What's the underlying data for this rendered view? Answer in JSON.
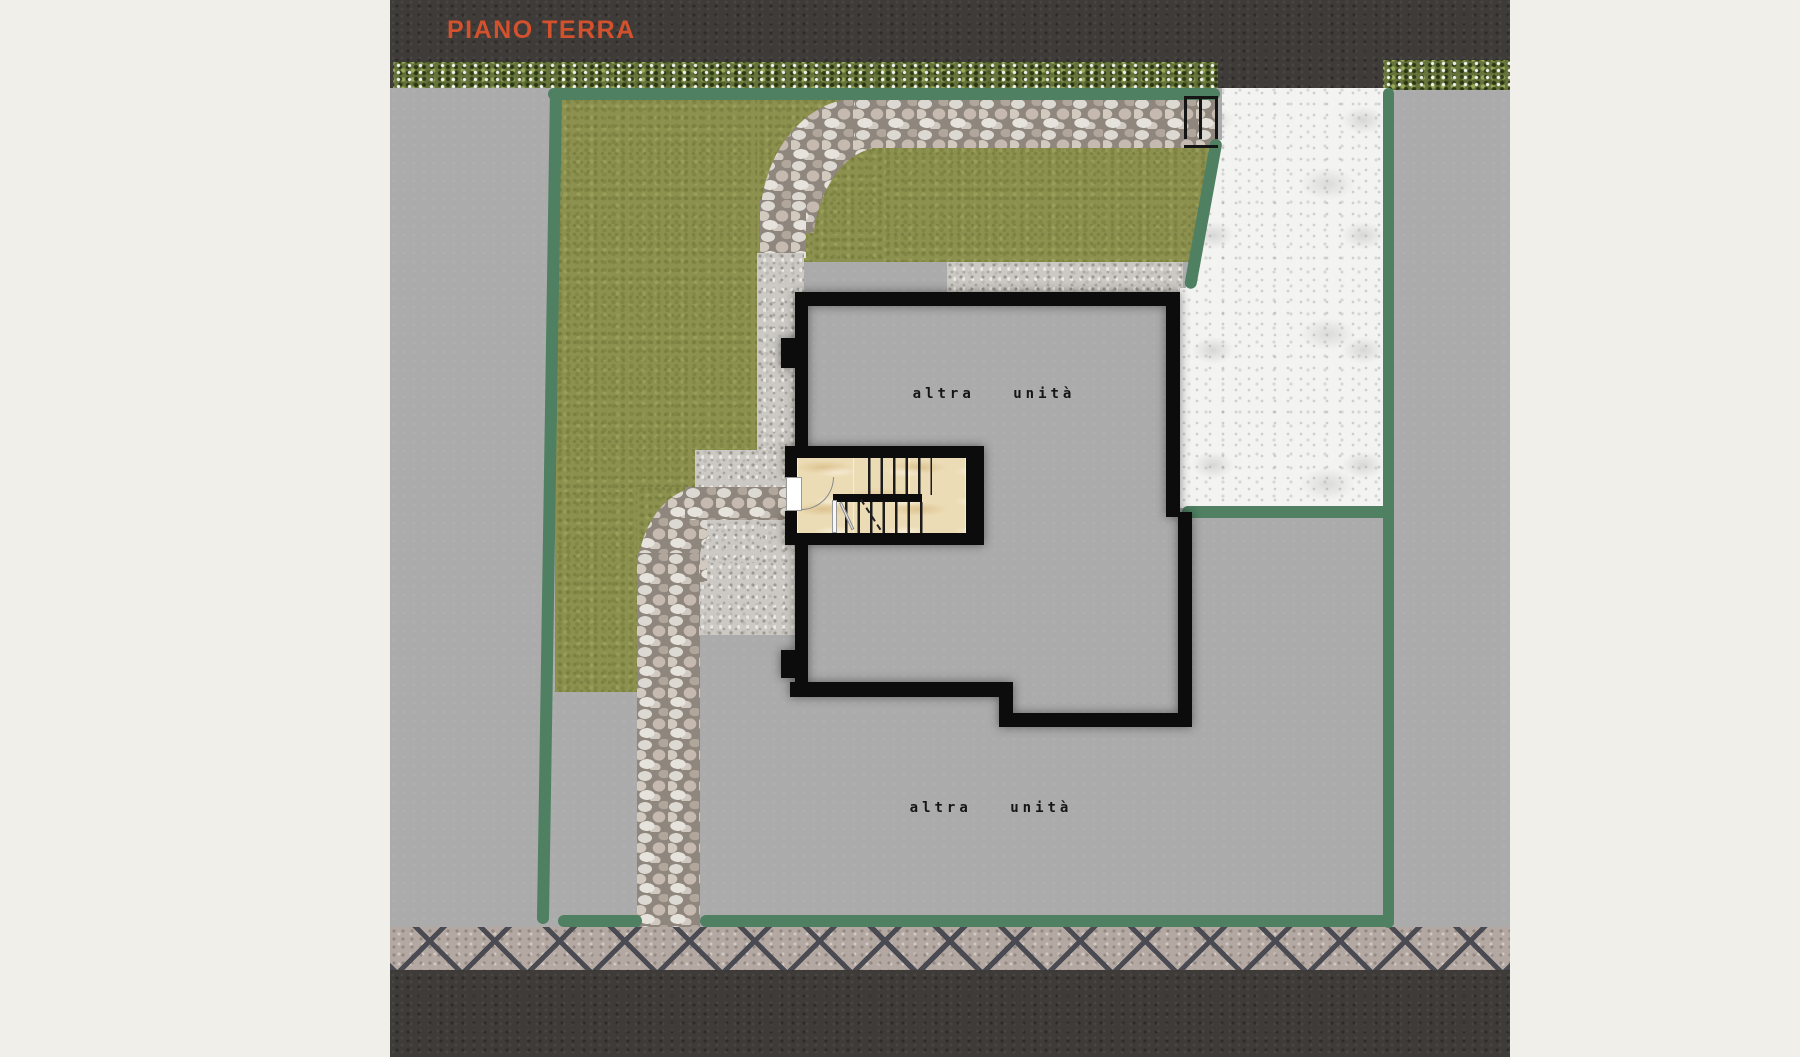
{
  "plan": {
    "title": "PIANO TERRA",
    "unit_label_upper": "altra unità",
    "unit_label_lower": "altra unità"
  },
  "colors": {
    "page_bg": "#f0efe9",
    "asphalt": "#3e3b38",
    "title": "#d4512d",
    "concrete": "#ababab",
    "white_concrete": "#f3f3f2",
    "lawn": "#8d914f",
    "hedge": "#66743c",
    "boundary_green": "#4e8061",
    "wall_black": "#0c0c0c",
    "marble": "#ecdcb6",
    "cobble_joint": "#4a4a52"
  }
}
